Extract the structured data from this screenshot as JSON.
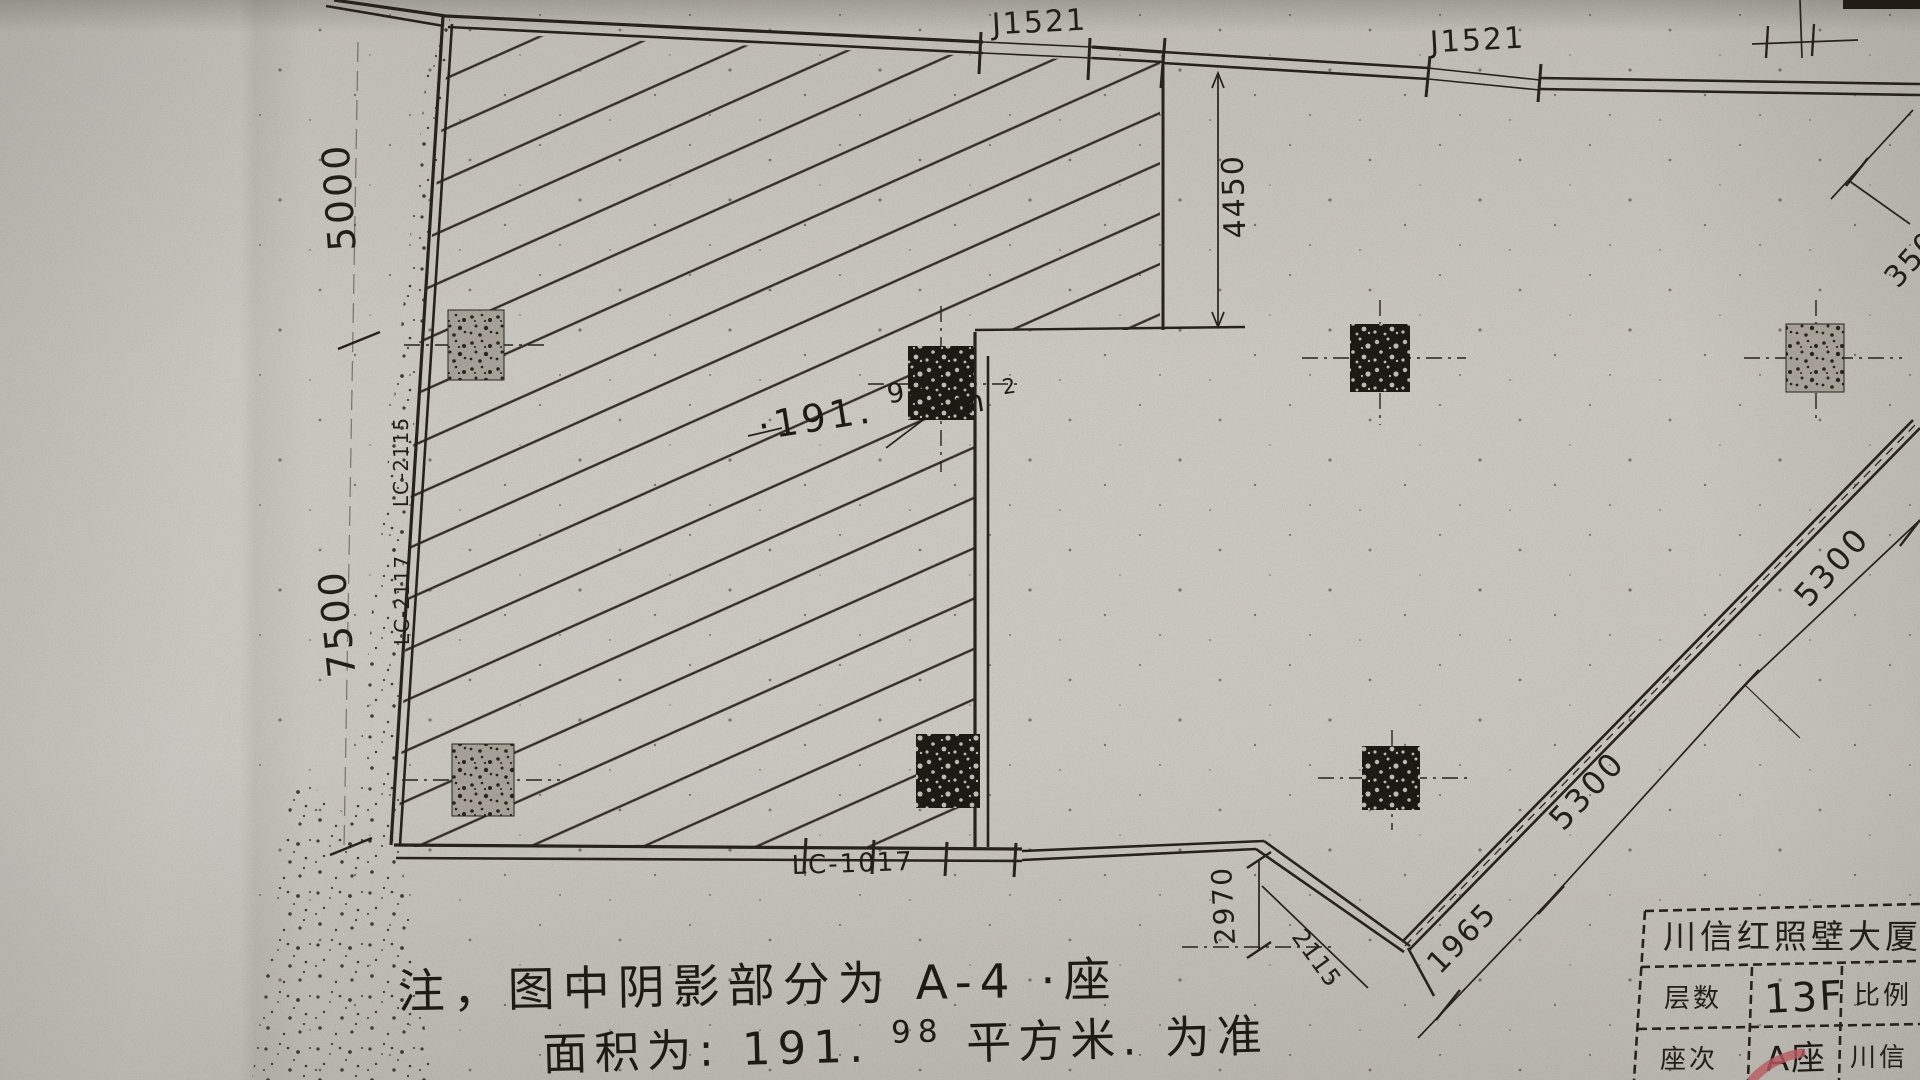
{
  "labels": {
    "j1521_a": "J1521",
    "j1521_b": "J1521",
    "dim_5000": "5000",
    "dim_7500": "7500",
    "dim_4450": "4450",
    "lc_upper": "LC-2115",
    "lc_lower": "LC-2117",
    "lc_bottom": "LC-1017",
    "dim_2970": "2970",
    "dim_2115": "2115",
    "dim_1965": "1965",
    "dim_5300_low": "5300",
    "dim_5300_high": "5300",
    "dim_3500": "3500"
  },
  "area_annotation": {
    "number": "·191.",
    "sup": "98",
    "unit_base": "m",
    "unit_sup": "2"
  },
  "note": {
    "line1": "注，图中阴影部分为 A-4 ·座",
    "line2_prefix": "面积为: 191.",
    "line2_sup": "98",
    "line2_suffix": " 平方米. 为准"
  },
  "title_block": {
    "title": "川信红照壁大厦（",
    "row1_label": "层数",
    "row1_value": "13F",
    "row1_right": "比例",
    "row2_label": "座次",
    "row2_value": "A座",
    "row2_right": "川信"
  },
  "colors": {
    "ink": "#2b2620",
    "paper": "#d7d3cc",
    "red_mark": "#c9646a"
  }
}
